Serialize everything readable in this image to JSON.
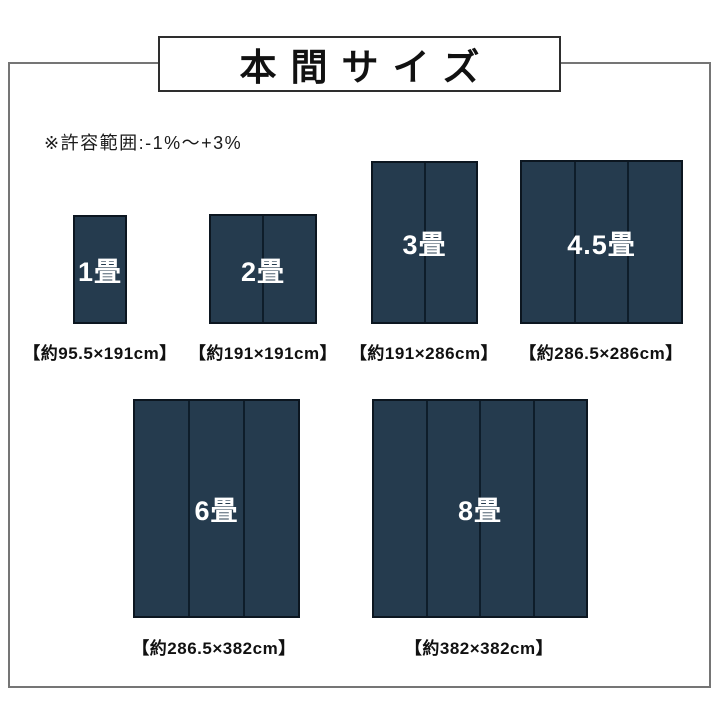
{
  "header": {
    "title": "本間サイズ"
  },
  "note": {
    "text": "※許容範囲:-1%〜+3%"
  },
  "colors": {
    "mat_fill": "#253b4e",
    "mat_border": "#0c1620",
    "mat_divider": "#0e1d2a",
    "mat_label_text": "#ffffff",
    "frame_border": "#757575",
    "title_box_border": "#2e2e2e",
    "text": "#111111"
  },
  "diagram": {
    "mats": [
      {
        "id": "1jo",
        "label": "1畳",
        "size_label": "【約95.5×191cm】",
        "width_cm": 95.5,
        "height_cm": 191,
        "panels": 1,
        "rect": {
          "x": 73,
          "y": 215,
          "w": 54,
          "h": 109
        },
        "label_center_x": 100,
        "size_label_top": 339
      },
      {
        "id": "2jo",
        "label": "2畳",
        "size_label": "【約191×191cm】",
        "width_cm": 191,
        "height_cm": 191,
        "panels": 2,
        "rect": {
          "x": 209,
          "y": 214,
          "w": 108,
          "h": 110
        },
        "label_center_x": 263,
        "size_label_top": 339
      },
      {
        "id": "3jo",
        "label": "3畳",
        "size_label": "【約191×286cm】",
        "width_cm": 191,
        "height_cm": 286,
        "panels": 2,
        "rect": {
          "x": 371,
          "y": 161,
          "w": 107,
          "h": 163
        },
        "label_center_x": 424,
        "size_label_top": 339
      },
      {
        "id": "4_5jo",
        "label": "4.5畳",
        "size_label": "【約286.5×286cm】",
        "width_cm": 286.5,
        "height_cm": 286,
        "panels": 3,
        "rect": {
          "x": 520,
          "y": 160,
          "w": 163,
          "h": 164
        },
        "label_center_x": 601,
        "size_label_top": 339
      },
      {
        "id": "6jo",
        "label": "6畳",
        "size_label": "【約286.5×382cm】",
        "width_cm": 286.5,
        "height_cm": 382,
        "panels": 3,
        "rect": {
          "x": 133,
          "y": 399,
          "w": 167,
          "h": 219
        },
        "label_center_x": 214,
        "size_label_top": 634
      },
      {
        "id": "8jo",
        "label": "8畳",
        "size_label": "【約382×382cm】",
        "width_cm": 382,
        "height_cm": 382,
        "panels": 4,
        "rect": {
          "x": 372,
          "y": 399,
          "w": 216,
          "h": 219
        },
        "label_center_x": 479,
        "size_label_top": 634
      }
    ]
  }
}
